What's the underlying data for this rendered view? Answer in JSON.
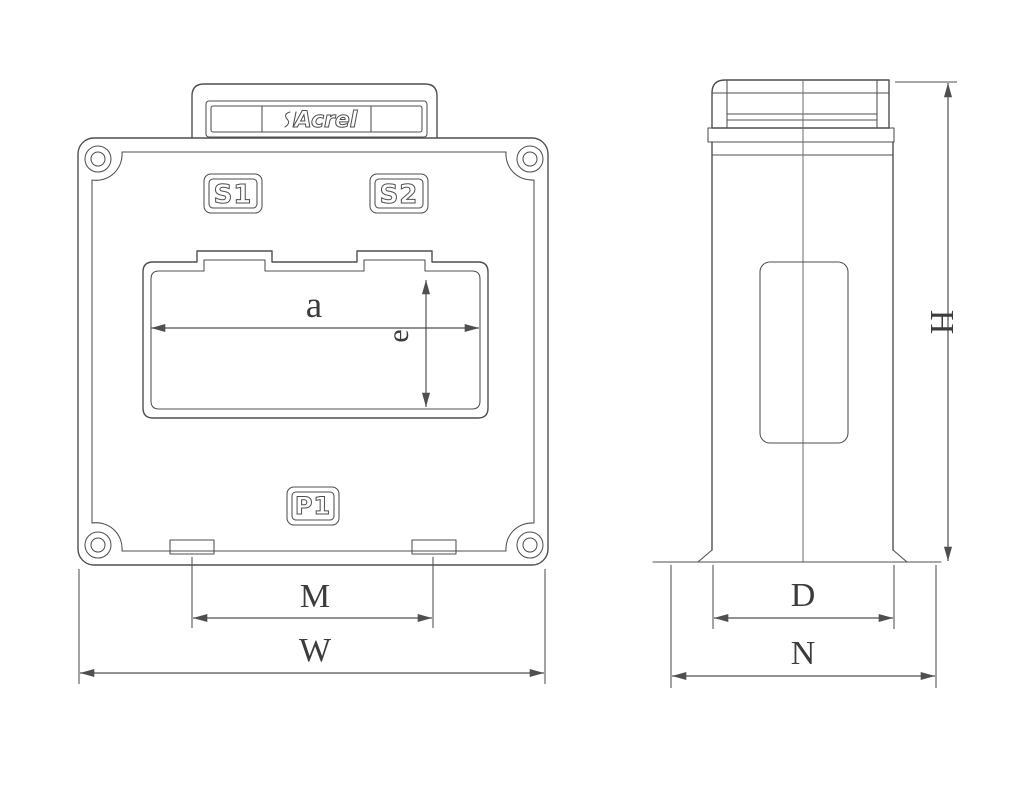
{
  "drawing": {
    "brand": {
      "logo_text": "Acrel"
    },
    "front_view": {
      "label_s1": "S1",
      "label_s2": "S2",
      "label_p1": "P1",
      "dim_a": "a",
      "dim_e": "e",
      "dim_m": "M",
      "dim_w": "W"
    },
    "side_view": {
      "dim_h": "H",
      "dim_d": "D",
      "dim_n": "N"
    }
  },
  "colors": {
    "line": "#4f4f4f",
    "dim_text": "#3c3c3c",
    "background": "#ffffff"
  }
}
